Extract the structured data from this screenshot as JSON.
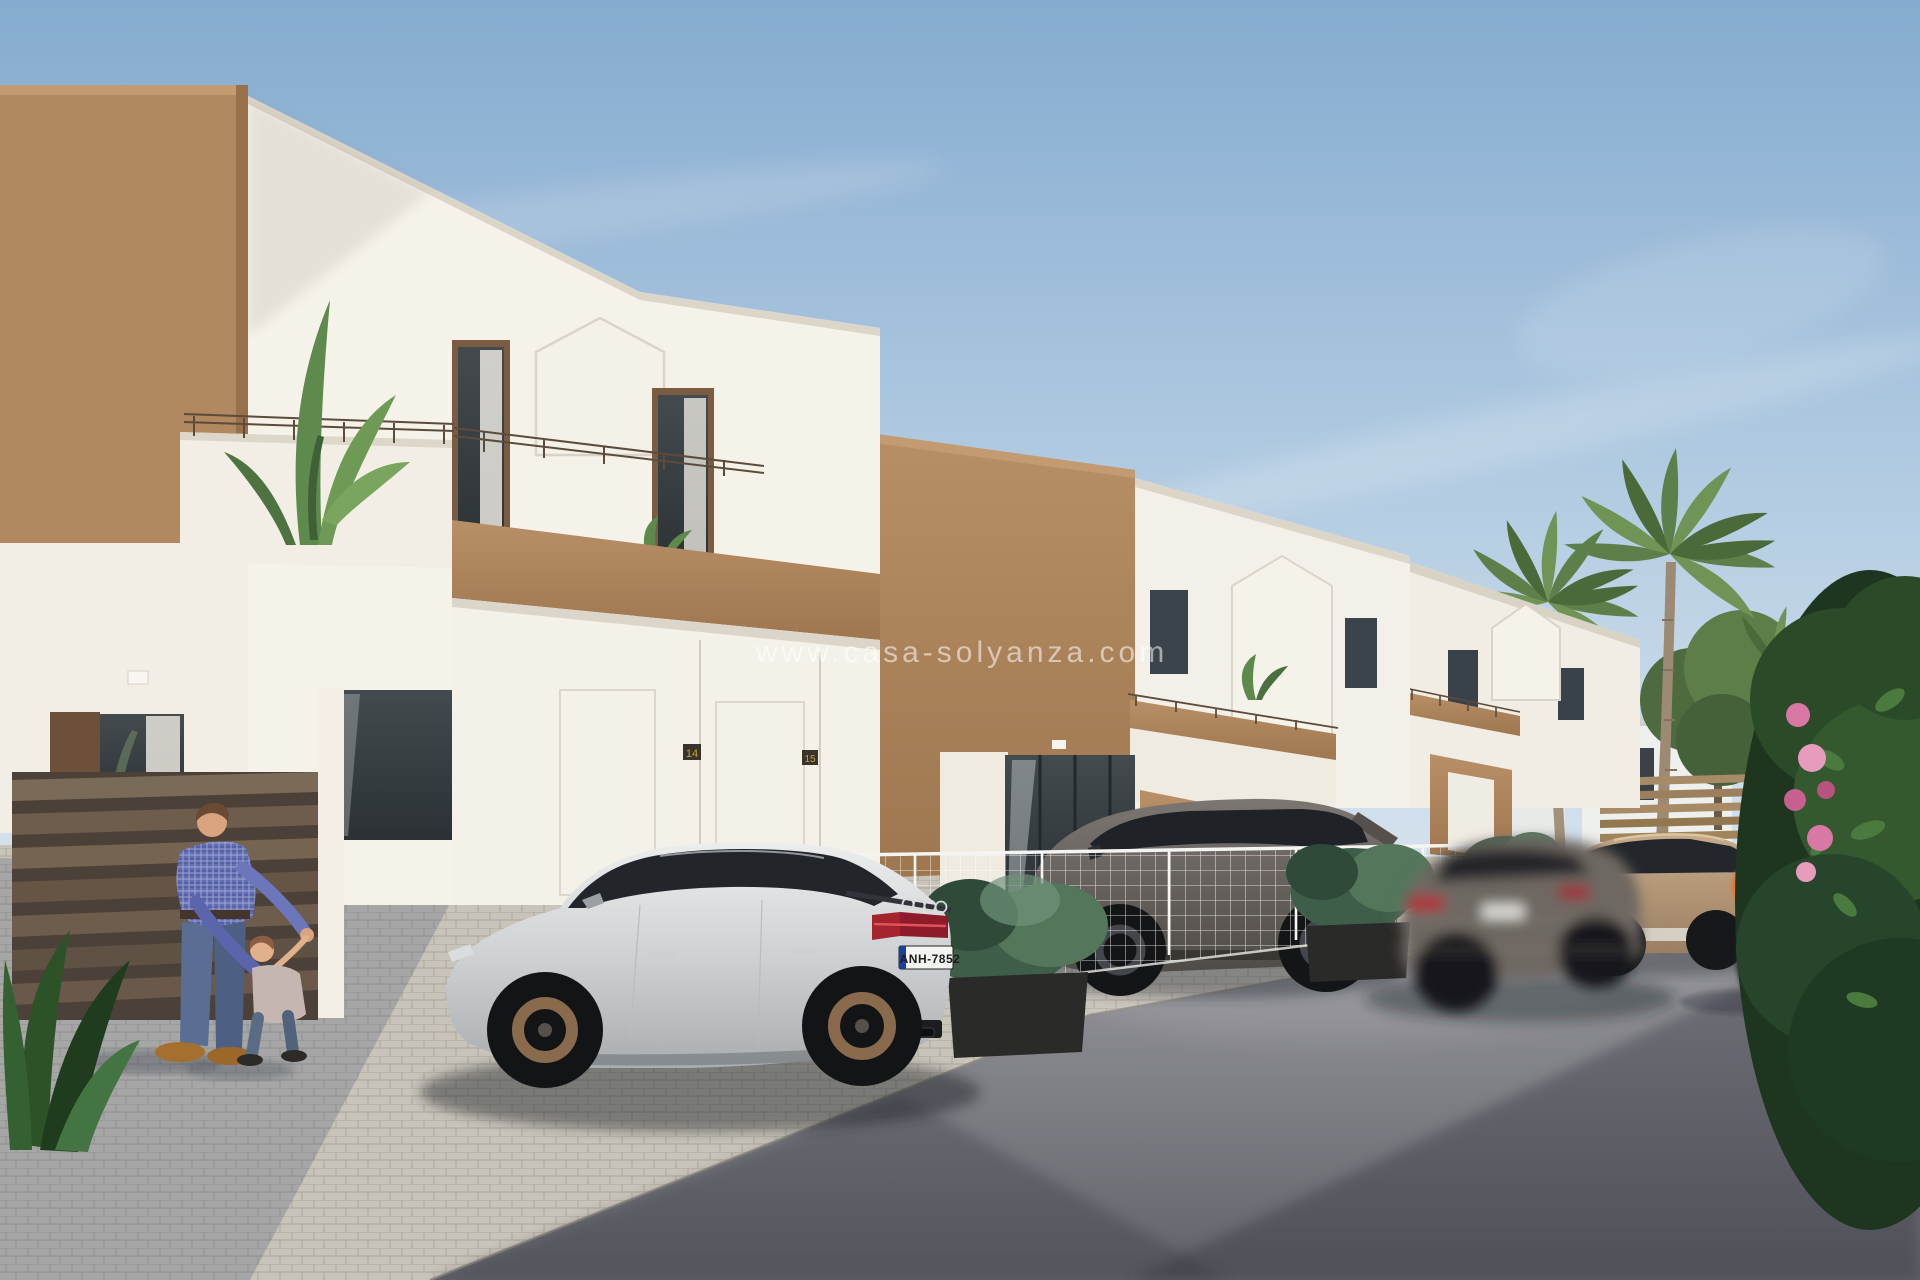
{
  "overlay": {
    "watermark": "www.casa-solyanza.com"
  },
  "vehicles": {
    "audi": {
      "description": "silver sportback sedan parked in driveway",
      "license_plate": "ANH-7852",
      "badge": "RS5"
    },
    "suv": {
      "description": "dark grey SUV parked behind white mesh fence"
    },
    "moving_car": {
      "description": "grey hatchback driving, motion-blurred"
    },
    "beige_suv": {
      "description": "beige SUV parked near far fence"
    }
  },
  "houses": {
    "style": "modern white two-storey townhouses with tan accent volumes and flat roofs",
    "number_left": "14",
    "number_right": "15"
  },
  "people": {
    "man": "man in blue plaid shirt and jeans playing with toddler",
    "child": "toddler in grey shirt held by both hands",
    "cyclist": "woman in yellow patterned top with orange bag riding a bicycle"
  },
  "vegetation": {
    "palms": "tall palm trees behind rear houses",
    "terrace_plant": "banana plant on first-floor terrace",
    "flower_bush": "large dark-green bush with pink blossoms at right edge"
  },
  "palette": {
    "sky_top": "#85abd0",
    "sky_horizon": "#d8e4ee",
    "wall_white": "#f5f2ea",
    "accent_tan": "#b08a63",
    "fence_brown": "#6e5d4d",
    "road_grey": "#6a6a72",
    "cobble": "#c9c4ba",
    "car_silver": "#d5d7d8",
    "suv_grey": "#6e6a66",
    "suv_beige": "#b79b7c",
    "palm_green": "#5d7f49",
    "bush_green": "#2b4a28",
    "flower_pink": "#d977a5"
  }
}
